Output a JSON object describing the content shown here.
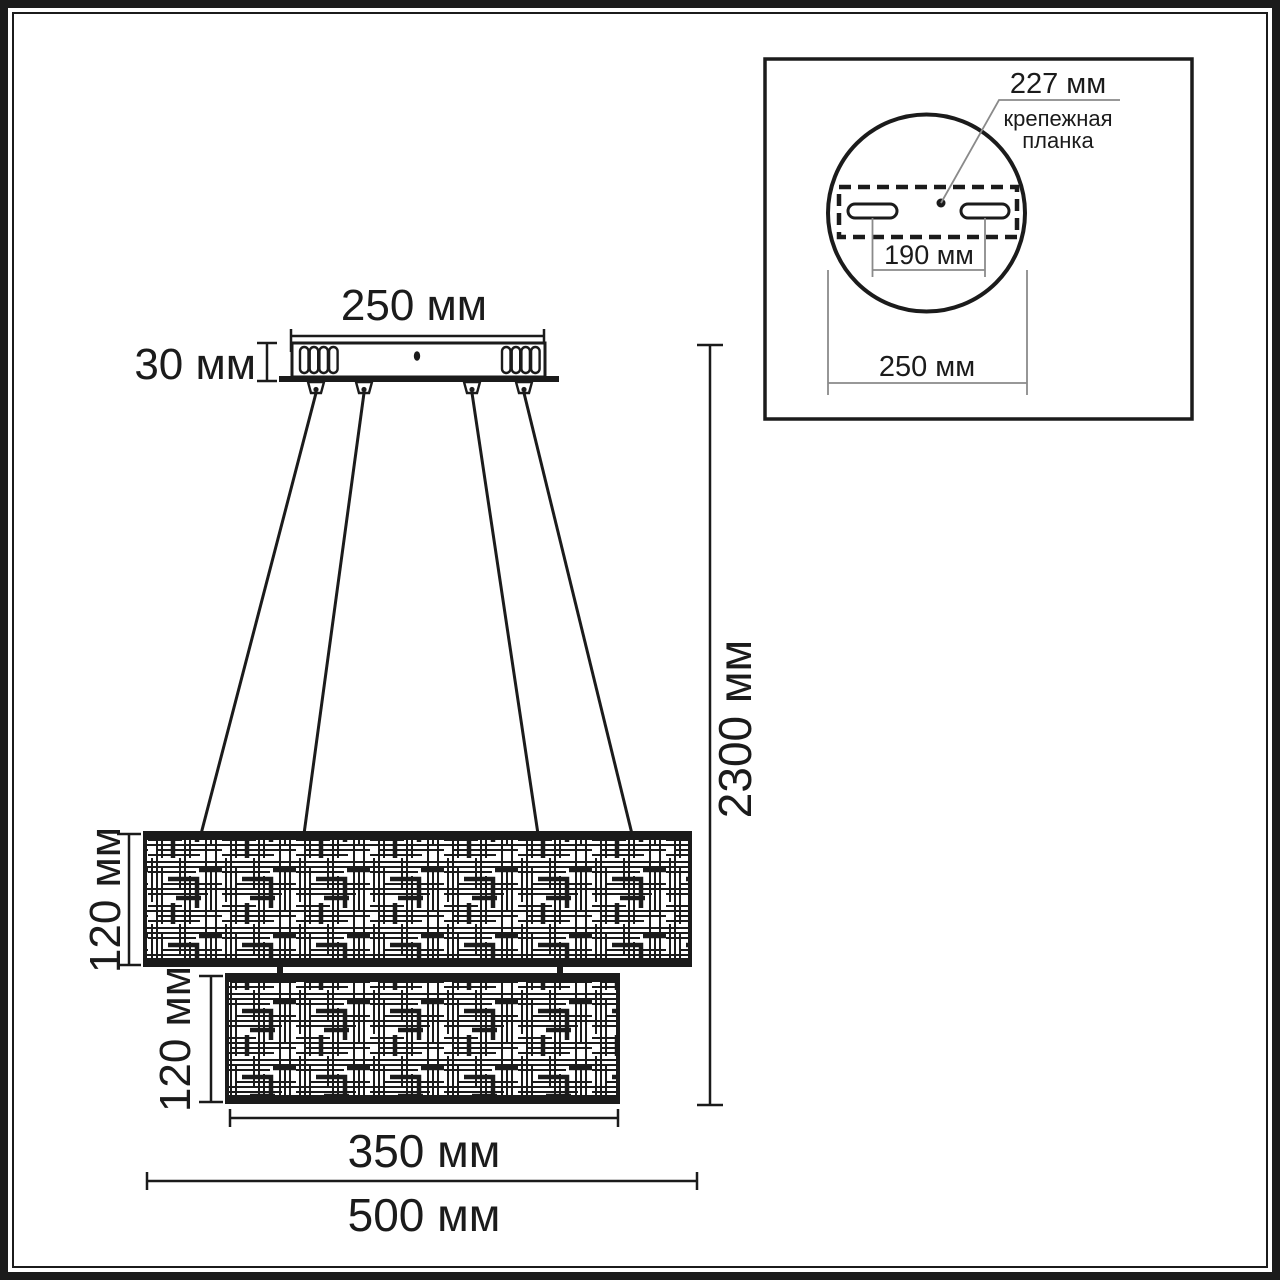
{
  "diagram": {
    "type": "chandelier-dimension-drawing",
    "main": {
      "canopy_width": "250 мм",
      "canopy_height": "30 мм",
      "suspension_height": "2300 мм",
      "upper_shade_height": "120 мм",
      "lower_shade_height": "120 мм",
      "lower_shade_width": "350 мм",
      "upper_shade_width": "500 мм"
    },
    "inset": {
      "bracket_length": "227 мм",
      "bracket_label_line1": "крепежная",
      "bracket_label_line2": "планка",
      "hole_spacing": "190 мм",
      "base_diameter": "250 мм"
    },
    "colors": {
      "ink": "#1b1b1b",
      "thin_line": "#8a8a8a",
      "background": "#ffffff"
    }
  }
}
